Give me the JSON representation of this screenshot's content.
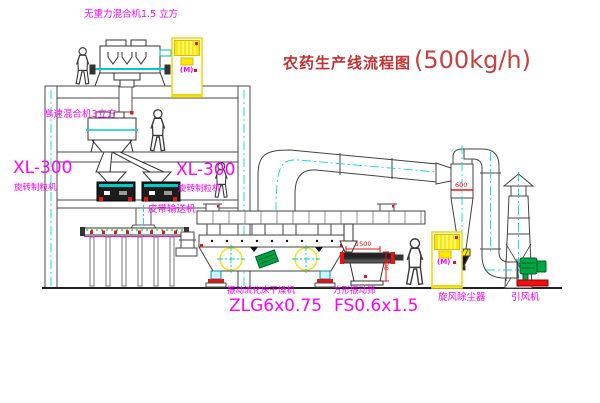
{
  "title": {
    "text": "农药生产线流程图",
    "capacity": "(500kg/h)"
  },
  "machines": {
    "gravity_mixer": {
      "label": "无重力混合机1.5 立方"
    },
    "high_speed_mixer": {
      "label": "高速混合机3立方"
    },
    "granulator_left": {
      "model": "XL-300",
      "name": "旋转制粒机"
    },
    "granulator_right": {
      "model": "XL-300",
      "name": "旋转制粒机"
    },
    "belt_conveyor": {
      "label": "皮带输送机"
    },
    "dryer": {
      "name": "振动流化床干燥机",
      "model": "ZLG6x0.75"
    },
    "sieve": {
      "name": "方形振动筛",
      "model": "FS0.6x1.5"
    },
    "cyclone": {
      "label": "旋风除尘器"
    },
    "fan": {
      "label": "引风机"
    }
  },
  "annotations": {
    "motor_symbol_top": "(M)",
    "motor_symbol_bottom": "(M)",
    "dim_sieve_length": "1500",
    "dim_sieve_height": "500",
    "dim_cyclone": "600"
  },
  "colors": {
    "label_magenta": "#ff00ff",
    "title_red": "#c53030",
    "centerline_cyan": "#00dddd",
    "cabinet_yellow": "#f0d800",
    "accent_red": "#ee1111",
    "fan_green": "#00a544"
  }
}
